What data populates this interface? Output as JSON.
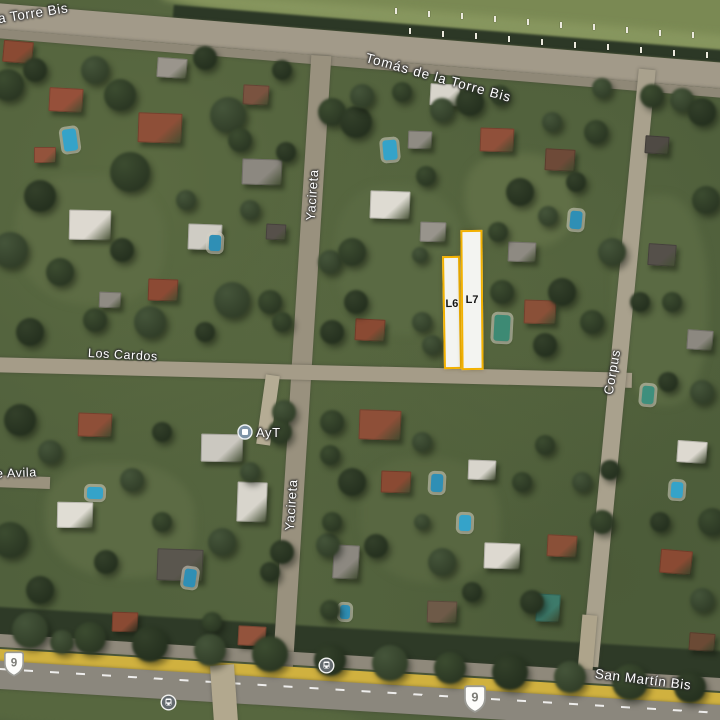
{
  "map": {
    "street_labels": {
      "torre_bis_partial": "la Torre Bis",
      "tomas_de_la_torre": "Tomás de la Torre Bis",
      "yacireta_north": "Yacireta",
      "yacireta_south": "Yacireta",
      "los_cardos": "Los Cardos",
      "corpus": "Corpus",
      "san_martin_bis": "San Martín Bis",
      "avila_partial": "e Avila"
    },
    "poi": {
      "ayt": "AyT"
    },
    "lots": [
      {
        "label": "L6"
      },
      {
        "label": "L7"
      }
    ],
    "route_shields": [
      {
        "number": "9"
      },
      {
        "number": "9"
      }
    ],
    "highlight_border_color": "#F2B101",
    "lot_fill_color": "rgba(255,255,255,0.93)"
  },
  "scene": {
    "base_color": "#50603c",
    "tree_palette": [
      [
        "#3c4c30",
        "#242f1e"
      ],
      [
        "#33402a",
        "#1f2a1a"
      ],
      [
        "#45553a",
        "#2a3622"
      ]
    ],
    "fields": [
      [
        "pasture-field",
        560,
        14,
        830,
        85,
        4.7,
        "#7a8953"
      ],
      [
        "pasture-mown-strip",
        555,
        30,
        790,
        18,
        4.7,
        "#87965e"
      ],
      [
        "top-treeline",
        552,
        42,
        760,
        13,
        4.7,
        "#2c3826"
      ],
      [
        "lawn-1",
        90,
        240,
        150,
        130,
        0,
        "#5d6c44"
      ],
      [
        "lawn-2",
        400,
        260,
        130,
        150,
        0,
        "#5a6a43"
      ],
      [
        "lawn-3",
        520,
        200,
        110,
        95,
        0,
        "#606f46"
      ],
      [
        "lawn-4",
        120,
        520,
        150,
        115,
        0,
        "#5c6b44"
      ],
      [
        "lawn-5",
        430,
        520,
        140,
        125,
        0,
        "#586741"
      ],
      [
        "lawn-6",
        660,
        300,
        95,
        210,
        0,
        "#5a6a43"
      ],
      [
        "bottom-treeline",
        360,
        644,
        840,
        30,
        3.5,
        "#2e3a27"
      ],
      [
        "bottom-grass",
        150,
        713,
        430,
        42,
        3.5,
        "#57673f"
      ]
    ],
    "roads": [
      {
        "n": "tomas-de-la-torre-road",
        "x": 360,
        "y": 46,
        "w": 860,
        "h": 26,
        "r": 4.7,
        "c": "#a29a89"
      },
      {
        "n": "top-road-shoulder",
        "x": 360,
        "y": 63,
        "w": 860,
        "h": 9,
        "r": 4.7,
        "c": "#8f8877"
      },
      {
        "n": "yacireta-road",
        "x": 302,
        "y": 362,
        "w": 20,
        "h": 615,
        "r": 3.6,
        "c": "#99917e"
      },
      {
        "n": "los-cardos-road",
        "x": 312,
        "y": 372,
        "w": 640,
        "h": 15,
        "r": 1.4,
        "c": "#a59c88"
      },
      {
        "n": "corpus-road",
        "x": 618,
        "y": 368,
        "w": 17,
        "h": 600,
        "r": 5.5,
        "c": "#a9a18d"
      },
      {
        "n": "ayt-driveway",
        "x": 268,
        "y": 410,
        "w": 14,
        "h": 70,
        "r": 8,
        "c": "#b5ac94"
      },
      {
        "n": "west-stub-road",
        "x": 22,
        "y": 482,
        "w": 56,
        "h": 12,
        "r": 2,
        "c": "#9a927e"
      },
      {
        "n": "corpus-south-stub",
        "x": 587,
        "y": 642,
        "w": 15,
        "h": 55,
        "r": 5,
        "c": "#aea48b"
      },
      {
        "n": "highway-north-lanes",
        "x": 360,
        "y": 662,
        "w": 810,
        "h": 13,
        "r": 3.5,
        "c": "#8f897b"
      },
      {
        "n": "highway-median",
        "x": 360,
        "y": 678,
        "w": 810,
        "h": 15,
        "r": 3.5,
        "c": "#d0b13f"
      },
      {
        "n": "highway-south-lanes",
        "x": 360,
        "y": 697,
        "w": 810,
        "h": 28,
        "r": 3.5,
        "c": "#8b877d",
        "dash": true
      },
      {
        "n": "dirt-crossing",
        "x": 224,
        "y": 694,
        "w": 24,
        "h": 58,
        "r": -4,
        "c": "#b2a88e"
      }
    ],
    "houses": [
      [
        18,
        52,
        30,
        22,
        5,
        "#8a4a33"
      ],
      [
        66,
        100,
        34,
        24,
        3,
        "#96503a"
      ],
      [
        160,
        128,
        44,
        30,
        2,
        "#8e4f38"
      ],
      [
        172,
        68,
        30,
        20,
        4,
        "#9a958c"
      ],
      [
        256,
        95,
        26,
        20,
        3,
        "#7a5340"
      ],
      [
        262,
        172,
        40,
        26,
        2,
        "#8c8880"
      ],
      [
        276,
        232,
        20,
        16,
        3,
        "#56504a"
      ],
      [
        90,
        225,
        42,
        30,
        1,
        "#ddd9d0"
      ],
      [
        205,
        237,
        34,
        26,
        2,
        "#cfccc4"
      ],
      [
        163,
        290,
        30,
        22,
        2,
        "#8c4a34"
      ],
      [
        45,
        155,
        22,
        16,
        0,
        "#93533c"
      ],
      [
        110,
        300,
        22,
        16,
        2,
        "#8f8b83"
      ],
      [
        390,
        205,
        40,
        28,
        2,
        "#dedbd2"
      ],
      [
        433,
        232,
        26,
        20,
        2,
        "#98948c"
      ],
      [
        370,
        330,
        30,
        22,
        3,
        "#8a4a33"
      ],
      [
        497,
        140,
        34,
        24,
        2,
        "#90503a"
      ],
      [
        560,
        160,
        30,
        22,
        3,
        "#6e4a38"
      ],
      [
        522,
        252,
        28,
        20,
        2,
        "#8e8a82"
      ],
      [
        540,
        312,
        32,
        24,
        2,
        "#8a5038"
      ],
      [
        420,
        140,
        24,
        18,
        2,
        "#8f8b83"
      ],
      [
        445,
        95,
        30,
        22,
        3,
        "#d8d4cb"
      ],
      [
        657,
        145,
        24,
        18,
        4,
        "#4f4a44"
      ],
      [
        662,
        255,
        28,
        22,
        4,
        "#55504a"
      ],
      [
        700,
        340,
        26,
        20,
        4,
        "#8c8880"
      ],
      [
        692,
        452,
        30,
        22,
        4,
        "#ddd9d0"
      ],
      [
        676,
        562,
        32,
        24,
        5,
        "#8a4a33"
      ],
      [
        702,
        642,
        26,
        18,
        4,
        "#6b4a35"
      ],
      [
        95,
        425,
        34,
        24,
        2,
        "#8e4f38"
      ],
      [
        222,
        448,
        42,
        28,
        1,
        "#cbc8c0"
      ],
      [
        252,
        502,
        30,
        40,
        2,
        "#d8d5cc"
      ],
      [
        75,
        515,
        36,
        26,
        1,
        "#e0ddd4"
      ],
      [
        180,
        565,
        46,
        32,
        2,
        "#5a564e"
      ],
      [
        125,
        622,
        26,
        20,
        2,
        "#8a4a33"
      ],
      [
        252,
        636,
        28,
        20,
        3,
        "#93533c"
      ],
      [
        380,
        425,
        42,
        30,
        2,
        "#8e4f38"
      ],
      [
        396,
        482,
        30,
        22,
        2,
        "#8a4a33"
      ],
      [
        482,
        470,
        28,
        20,
        2,
        "#d8d5cc"
      ],
      [
        502,
        556,
        36,
        26,
        2,
        "#ddd9d0"
      ],
      [
        562,
        546,
        30,
        22,
        3,
        "#8a5038"
      ],
      [
        442,
        612,
        30,
        22,
        2,
        "#6e5a48"
      ],
      [
        346,
        562,
        26,
        34,
        3,
        "#8c8880"
      ],
      [
        548,
        608,
        24,
        28,
        3,
        "#3d7a6a"
      ]
    ],
    "pools": [
      [
        70,
        140,
        14,
        22,
        -8,
        "#35a3c9"
      ],
      [
        215,
        243,
        12,
        16,
        3,
        "#2f8fb5"
      ],
      [
        390,
        150,
        14,
        20,
        -5,
        "#35a3c9"
      ],
      [
        576,
        220,
        12,
        18,
        5,
        "#2f8fb5"
      ],
      [
        95,
        493,
        16,
        12,
        2,
        "#35a3c9"
      ],
      [
        437,
        483,
        12,
        18,
        3,
        "#2f8fb5"
      ],
      [
        465,
        523,
        12,
        16,
        2,
        "#35a3c9"
      ],
      [
        190,
        578,
        12,
        18,
        8,
        "#2f8fb5"
      ],
      [
        677,
        490,
        12,
        16,
        4,
        "#35a3c9"
      ],
      [
        502,
        328,
        16,
        26,
        3,
        "#3d8a74"
      ],
      [
        648,
        395,
        12,
        18,
        5,
        "#3e8f7d"
      ],
      [
        345,
        612,
        10,
        14,
        2,
        "#2f8fb5"
      ]
    ],
    "trees": [
      [
        8,
        85,
        16
      ],
      [
        35,
        70,
        12
      ],
      [
        95,
        70,
        14
      ],
      [
        120,
        95,
        16
      ],
      [
        205,
        58,
        12
      ],
      [
        228,
        115,
        18
      ],
      [
        130,
        172,
        20
      ],
      [
        40,
        196,
        16
      ],
      [
        10,
        250,
        18
      ],
      [
        60,
        272,
        14
      ],
      [
        122,
        250,
        12
      ],
      [
        186,
        200,
        10
      ],
      [
        240,
        140,
        12
      ],
      [
        282,
        70,
        10
      ],
      [
        150,
        322,
        16
      ],
      [
        95,
        320,
        12
      ],
      [
        30,
        332,
        14
      ],
      [
        232,
        300,
        18
      ],
      [
        270,
        302,
        12
      ],
      [
        205,
        332,
        10
      ],
      [
        250,
        210,
        10
      ],
      [
        332,
        112,
        14
      ],
      [
        286,
        152,
        10
      ],
      [
        330,
        262,
        12
      ],
      [
        282,
        322,
        10
      ],
      [
        332,
        332,
        12
      ],
      [
        284,
        412,
        12
      ],
      [
        330,
        455,
        10
      ],
      [
        282,
        552,
        12
      ],
      [
        328,
        545,
        12
      ],
      [
        330,
        610,
        10
      ],
      [
        356,
        122,
        16
      ],
      [
        442,
        110,
        12
      ],
      [
        352,
        252,
        14
      ],
      [
        356,
        302,
        12
      ],
      [
        422,
        322,
        10
      ],
      [
        426,
        176,
        10
      ],
      [
        520,
        192,
        14
      ],
      [
        548,
        216,
        10
      ],
      [
        502,
        292,
        12
      ],
      [
        562,
        292,
        14
      ],
      [
        432,
        345,
        10
      ],
      [
        498,
        232,
        10
      ],
      [
        545,
        345,
        12
      ],
      [
        420,
        255,
        8
      ],
      [
        596,
        132,
        12
      ],
      [
        576,
        182,
        10
      ],
      [
        612,
        252,
        14
      ],
      [
        592,
        322,
        12
      ],
      [
        640,
        302,
        10
      ],
      [
        682,
        100,
        12
      ],
      [
        706,
        200,
        14
      ],
      [
        668,
        382,
        10
      ],
      [
        702,
        392,
        12
      ],
      [
        712,
        522,
        14
      ],
      [
        660,
        522,
        10
      ],
      [
        702,
        600,
        12
      ],
      [
        672,
        302,
        10
      ],
      [
        20,
        420,
        16
      ],
      [
        50,
        452,
        12
      ],
      [
        10,
        540,
        18
      ],
      [
        40,
        590,
        14
      ],
      [
        132,
        480,
        12
      ],
      [
        162,
        522,
        10
      ],
      [
        106,
        562,
        12
      ],
      [
        222,
        542,
        14
      ],
      [
        280,
        432,
        12
      ],
      [
        270,
        572,
        10
      ],
      [
        62,
        642,
        12
      ],
      [
        212,
        622,
        10
      ],
      [
        162,
        432,
        10
      ],
      [
        250,
        472,
        10
      ],
      [
        332,
        422,
        12
      ],
      [
        352,
        482,
        14
      ],
      [
        422,
        442,
        10
      ],
      [
        332,
        522,
        10
      ],
      [
        376,
        546,
        12
      ],
      [
        442,
        562,
        14
      ],
      [
        522,
        482,
        10
      ],
      [
        532,
        602,
        12
      ],
      [
        582,
        482,
        10
      ],
      [
        602,
        522,
        12
      ],
      [
        472,
        592,
        10
      ],
      [
        422,
        522,
        8
      ],
      [
        545,
        445,
        10
      ],
      [
        610,
        470,
        10
      ],
      [
        30,
        630,
        18
      ],
      [
        90,
        638,
        16
      ],
      [
        150,
        644,
        18
      ],
      [
        210,
        650,
        16
      ],
      [
        270,
        654,
        18
      ],
      [
        330,
        660,
        16
      ],
      [
        390,
        663,
        18
      ],
      [
        450,
        668,
        16
      ],
      [
        510,
        672,
        18
      ],
      [
        570,
        677,
        16
      ],
      [
        630,
        682,
        18
      ],
      [
        690,
        687,
        16
      ],
      [
        362,
        96,
        12
      ],
      [
        402,
        92,
        10
      ],
      [
        470,
        102,
        14
      ],
      [
        602,
        88,
        10
      ],
      [
        652,
        96,
        12
      ],
      [
        702,
        112,
        14
      ],
      [
        552,
        122,
        10
      ],
      [
        500,
        95,
        10
      ]
    ]
  }
}
